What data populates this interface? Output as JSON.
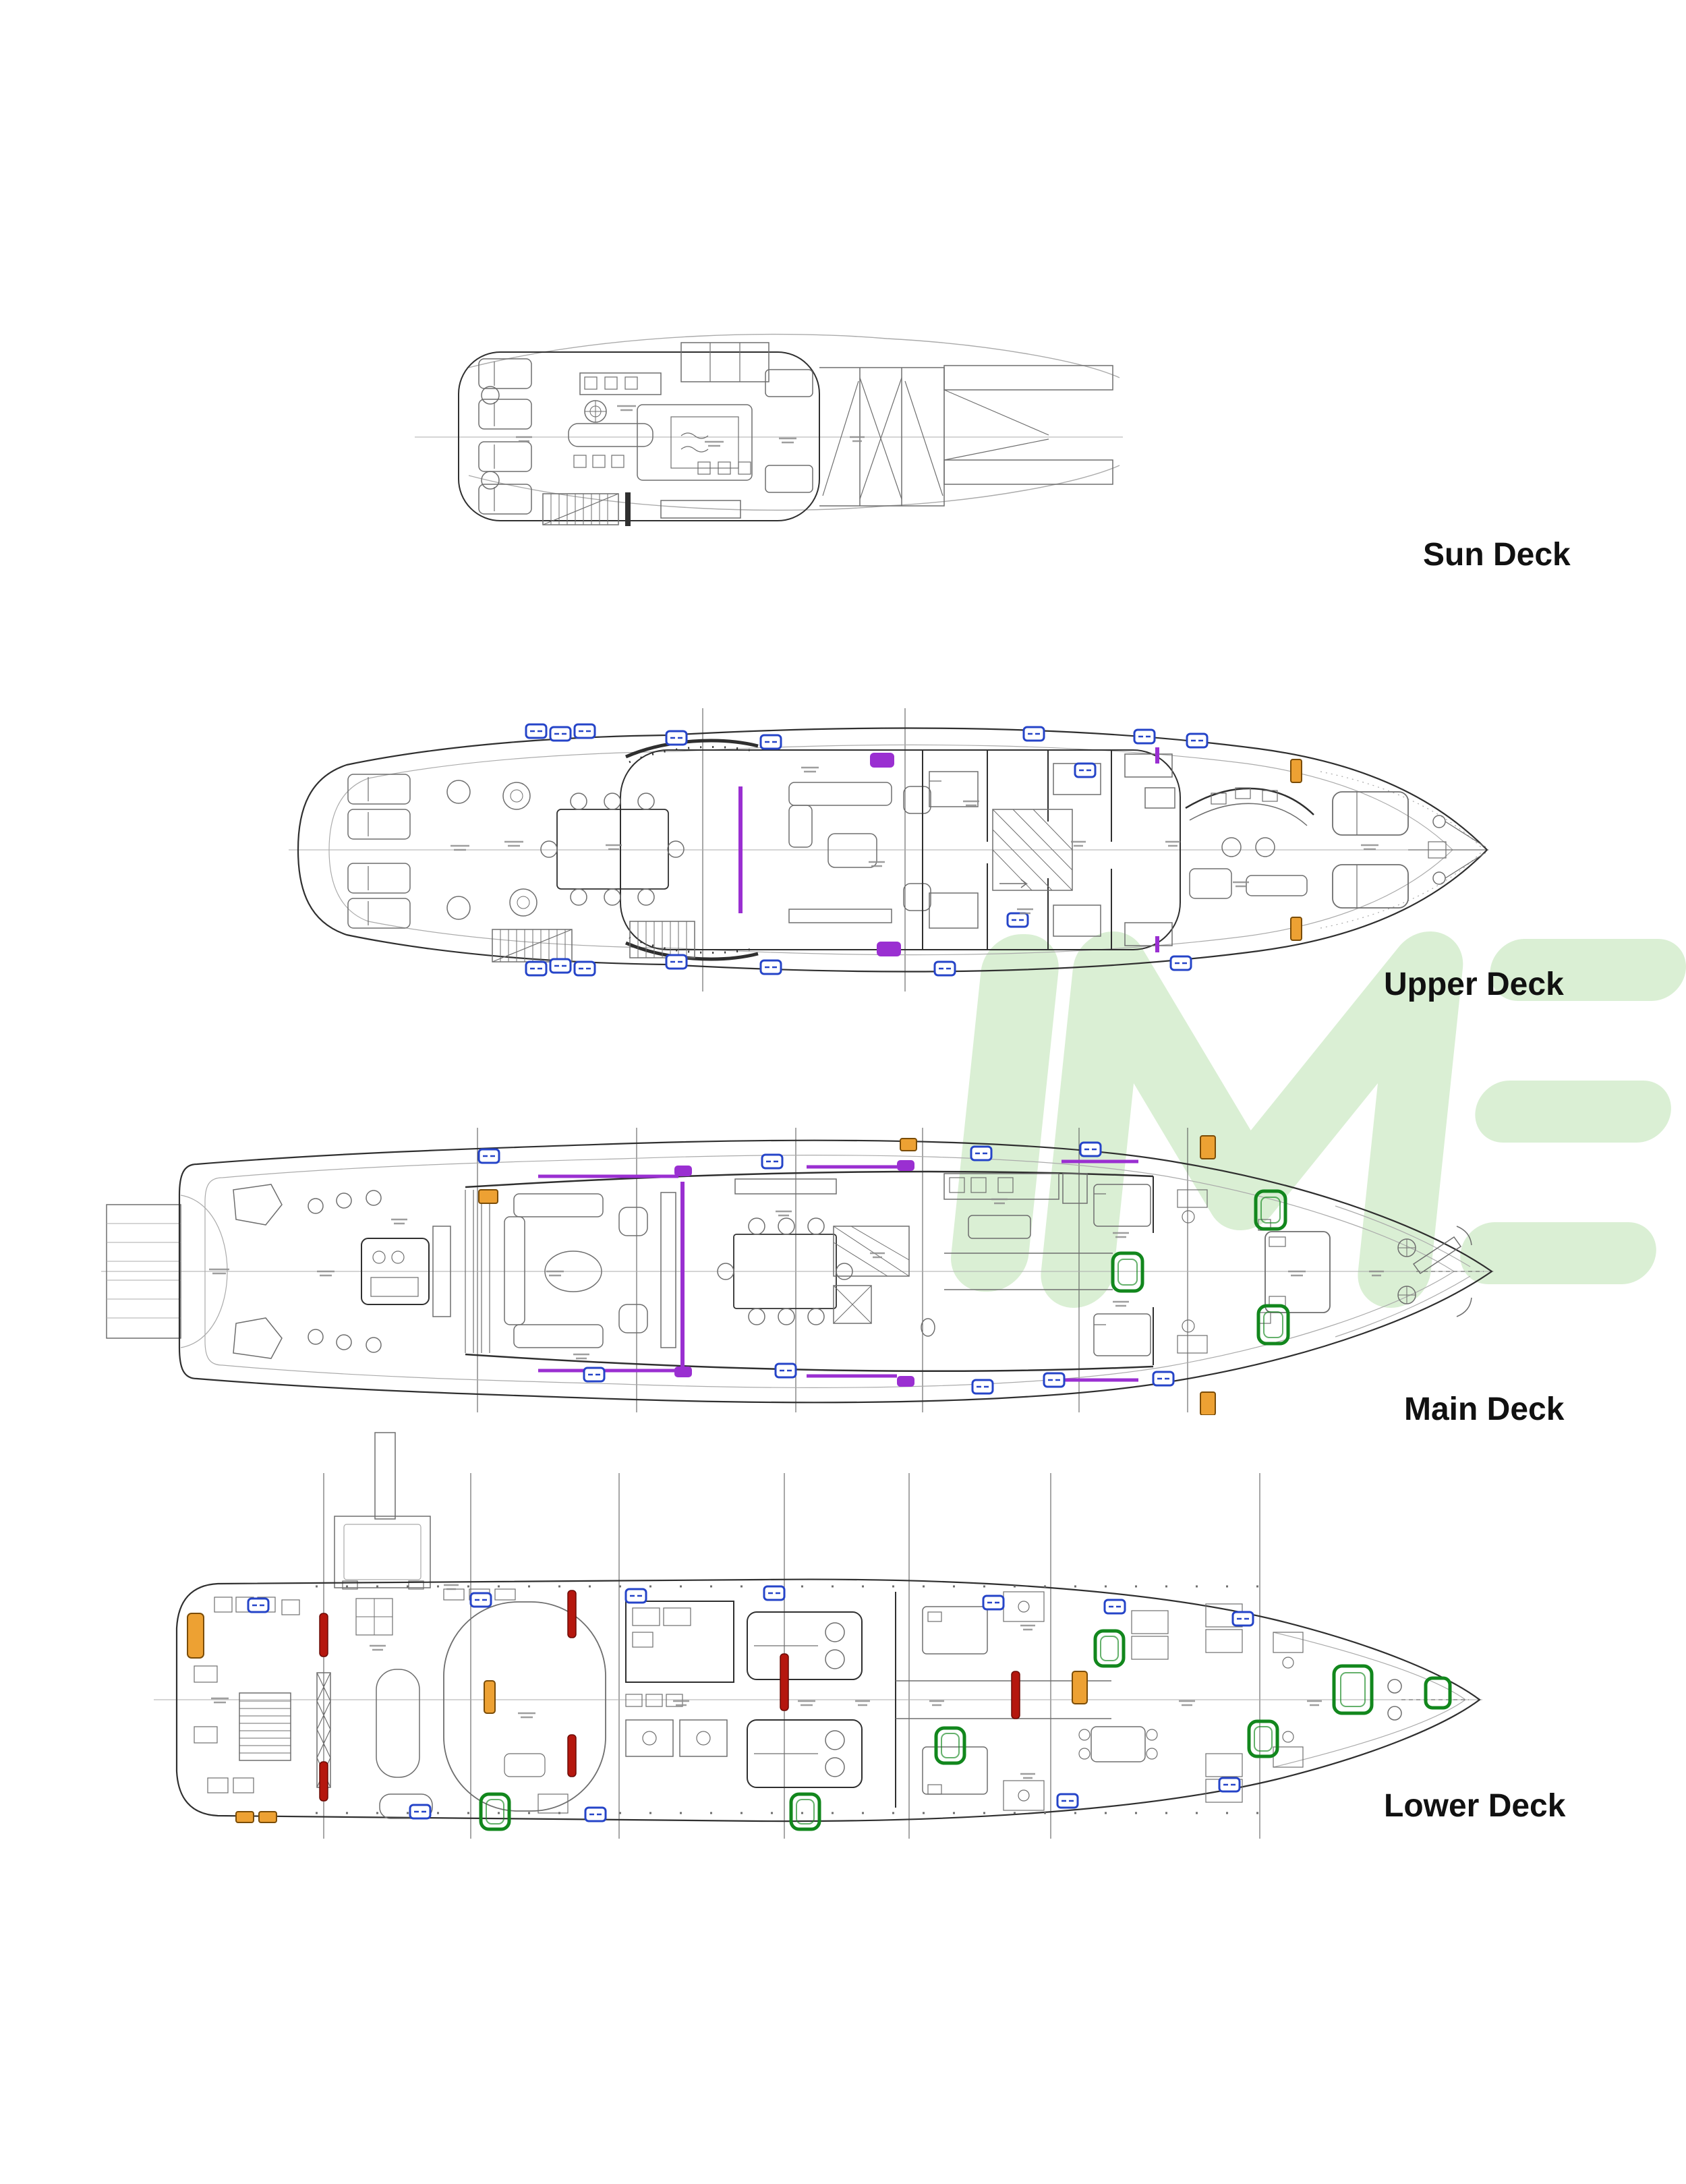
{
  "colors": {
    "page_bg": "#ffffff",
    "label_text": "#111111",
    "line_dark": "#2f2f2f",
    "line_mid": "#6e6e6e",
    "line_light": "#ababab",
    "micro_text": "#8d8d8d",
    "blue": "#2544c8",
    "purple": "#9a2fd1",
    "orange": "#eda133",
    "orange_dark": "#7a4c07",
    "green": "#12871d",
    "red": "#b5170e",
    "red_dark": "#6b0b06",
    "watermark": "#daefd4"
  },
  "watermark": {
    "text": "IME"
  },
  "decks": [
    {
      "id": "sun-deck",
      "label": "Sun Deck"
    },
    {
      "id": "upper-deck",
      "label": "Upper Deck"
    },
    {
      "id": "main-deck",
      "label": "Main Deck"
    },
    {
      "id": "lower-deck",
      "label": "Lower Deck"
    }
  ]
}
